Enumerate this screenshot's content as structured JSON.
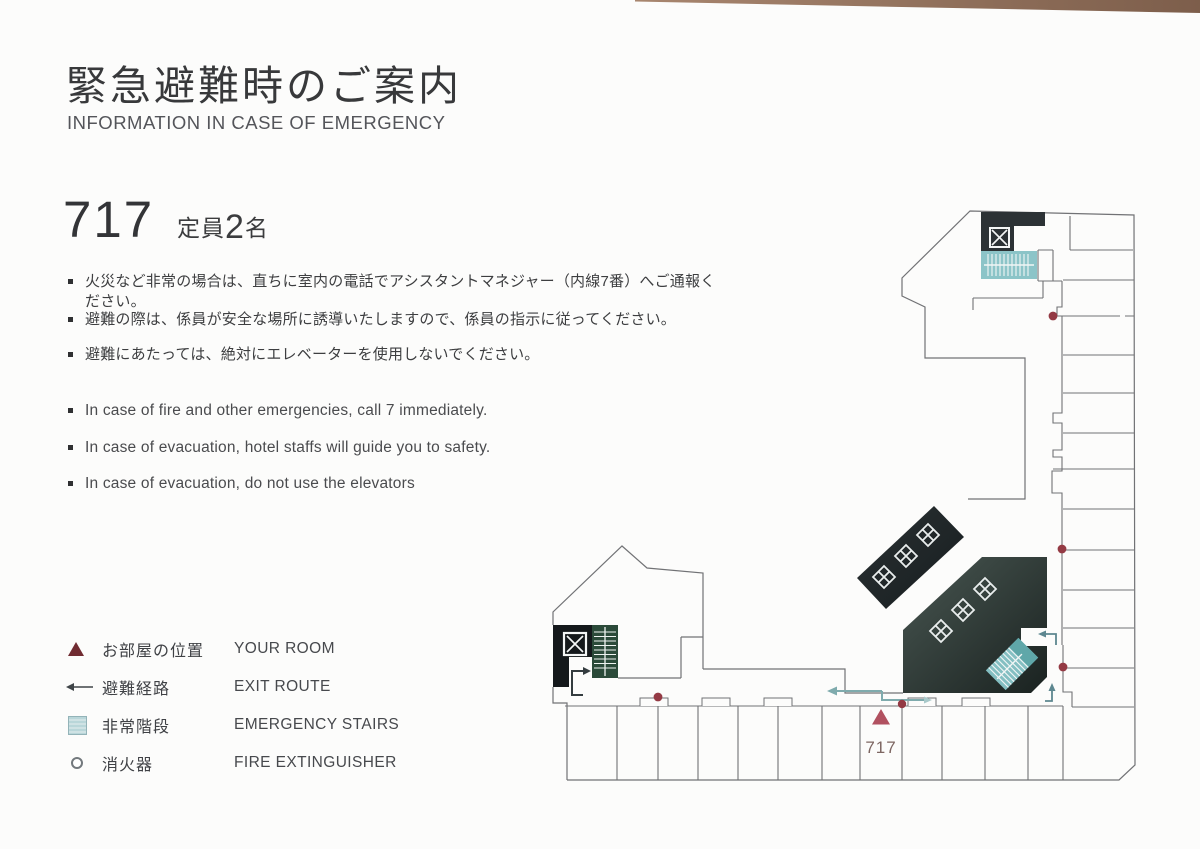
{
  "header": {
    "title_ja": "緊急避難時のご案内",
    "title_en": "INFORMATION IN CASE OF EMERGENCY"
  },
  "room": {
    "number": "717",
    "capacity_label": "定員",
    "capacity_number": "2",
    "capacity_unit": "名"
  },
  "notes_ja": [
    "火災など非常の場合は、直ちに室内の電話でアシスタントマネジャー（内線7番）へご通報ください。",
    "避難の際は、係員が安全な場所に誘導いたしますので、係員の指示に従ってください。",
    "避難にあたっては、絶対にエレベーターを使用しないでください。"
  ],
  "notes_en": [
    "In case of fire and other emergencies, call 7 immediately.",
    "In case of evacuation, hotel staffs will guide you to safety.",
    "In case of evacuation, do not use the elevators"
  ],
  "legend": [
    {
      "icon": "your-room-triangle",
      "ja": "お部屋の位置",
      "en": "YOUR ROOM"
    },
    {
      "icon": "exit-route-arrow",
      "ja": "避難経路",
      "en": "EXIT ROUTE"
    },
    {
      "icon": "emergency-stairs",
      "ja": "非常階段",
      "en": "EMERGENCY STAIRS"
    },
    {
      "icon": "fire-extinguisher",
      "ja": "消火器",
      "en": "FIRE EXTINGUISHER"
    }
  ],
  "map": {
    "room_label": "717"
  },
  "colors": {
    "accent_maroon": "#943a44",
    "room_triangle": "#b15160",
    "teal_stairs": "#8cc4c8",
    "green_stairs": "#2b4a39",
    "dark_block": "#23292b",
    "exit_arrow": "#7fabad",
    "wall_line": "#707173"
  }
}
